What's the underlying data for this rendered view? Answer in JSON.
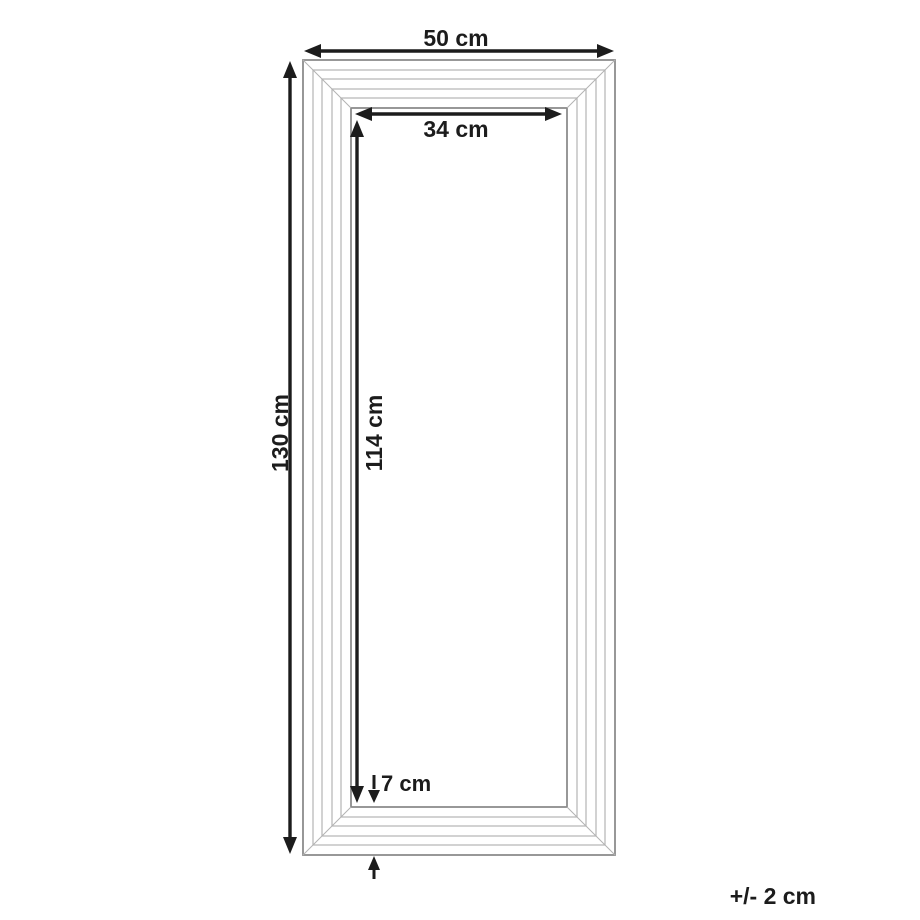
{
  "diagram": {
    "dimensions": {
      "outer_width": {
        "label": "50 cm",
        "value": 50,
        "unit": "cm"
      },
      "outer_height": {
        "label": "130 cm",
        "value": 130,
        "unit": "cm"
      },
      "inner_width": {
        "label": "34 cm",
        "value": 34,
        "unit": "cm"
      },
      "inner_height": {
        "label": "114 cm",
        "value": 114,
        "unit": "cm"
      },
      "frame_profile": {
        "label": "7 cm",
        "value": 7,
        "unit": "cm"
      }
    },
    "tolerance": {
      "label": "+/- 2 cm"
    },
    "colors": {
      "background": "#ffffff",
      "frame_edge": "#8c8c8c",
      "frame_contour": "#b3b3b3",
      "dimension": "#1c1c1c"
    }
  }
}
